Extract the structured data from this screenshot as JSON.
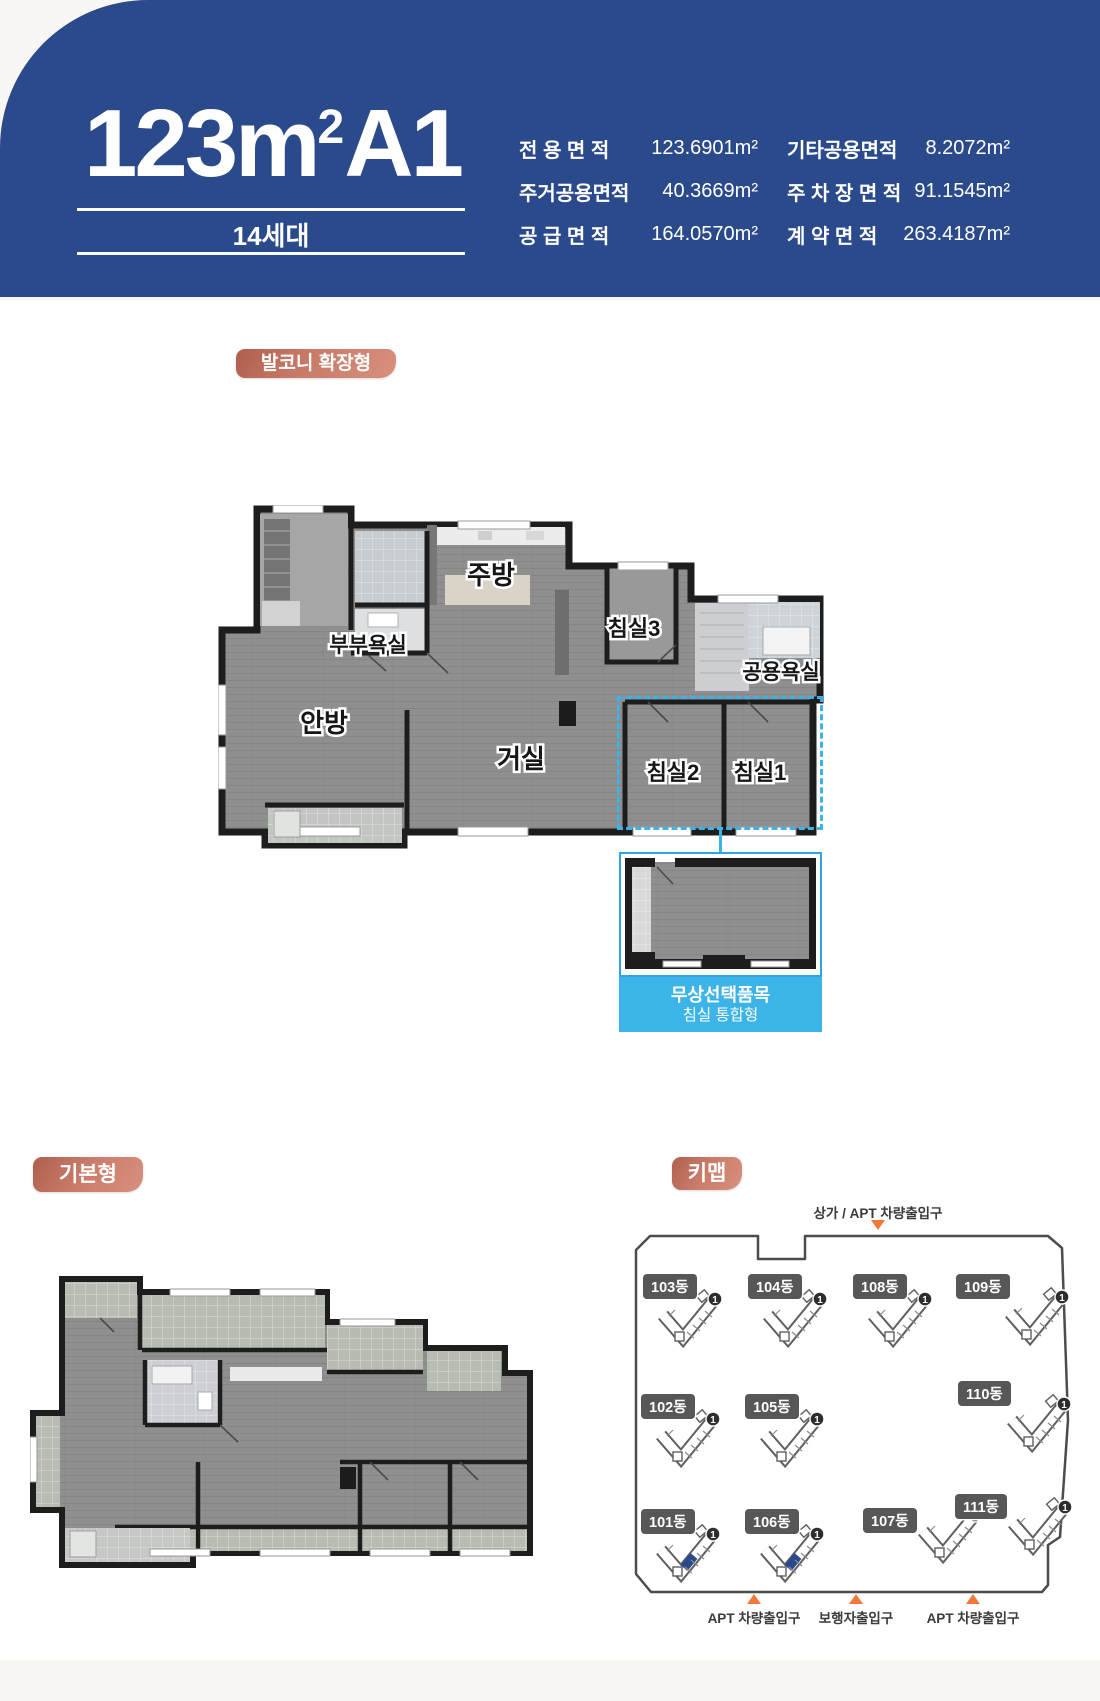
{
  "header": {
    "title_prefix": "123m",
    "title_sup": "2",
    "title_suffix": "A1",
    "units": "14세대",
    "specs_col1": [
      {
        "label": "전 용 면 적",
        "value": "123.6901m²"
      },
      {
        "label": "주거공용면적",
        "value": "40.3669m²"
      },
      {
        "label": "공 급 면 적",
        "value": "164.0570m²"
      }
    ],
    "specs_col2": [
      {
        "label": "기타공용면적",
        "value": "8.2072m²"
      },
      {
        "label": "주 차 장 면 적",
        "value": "91.1545m²"
      },
      {
        "label": "계 약 면 적",
        "value": "263.4187m²"
      }
    ]
  },
  "badges": {
    "extended": "발코니 확장형",
    "basic": "기본형",
    "keymap": "키맵"
  },
  "floorplan": {
    "rooms": {
      "kitchen": "주방",
      "master_bath": "부부욕실",
      "bedroom3": "침실3",
      "common_bath": "공용욕실",
      "master_bedroom": "안방",
      "living": "거실",
      "bedroom2": "침실2",
      "bedroom1": "침실1"
    },
    "option_line1": "무상선택품목",
    "option_line2": "침실 통합형"
  },
  "keymap": {
    "top_entrance": "상가 / APT 차량출입구",
    "bottom_entrances": [
      "APT 차량출입구",
      "보행자출입구",
      "APT 차량출입구"
    ],
    "buildings": [
      "103동",
      "104동",
      "108동",
      "109동",
      "102동",
      "105동",
      "110동",
      "101동",
      "106동",
      "107동",
      "111동"
    ],
    "highlighted_buildings": [
      "101동",
      "106동"
    ],
    "unit_marker": "1"
  },
  "colors": {
    "header_bg": "#2b4a8b",
    "badge_dark": "#b05f4e",
    "badge_light": "#d8907e",
    "option_blue": "#3db4e8",
    "dotted_blue": "#38b3eb",
    "entrance_orange": "#f0793a",
    "building_highlight": "#2b4a8b"
  }
}
